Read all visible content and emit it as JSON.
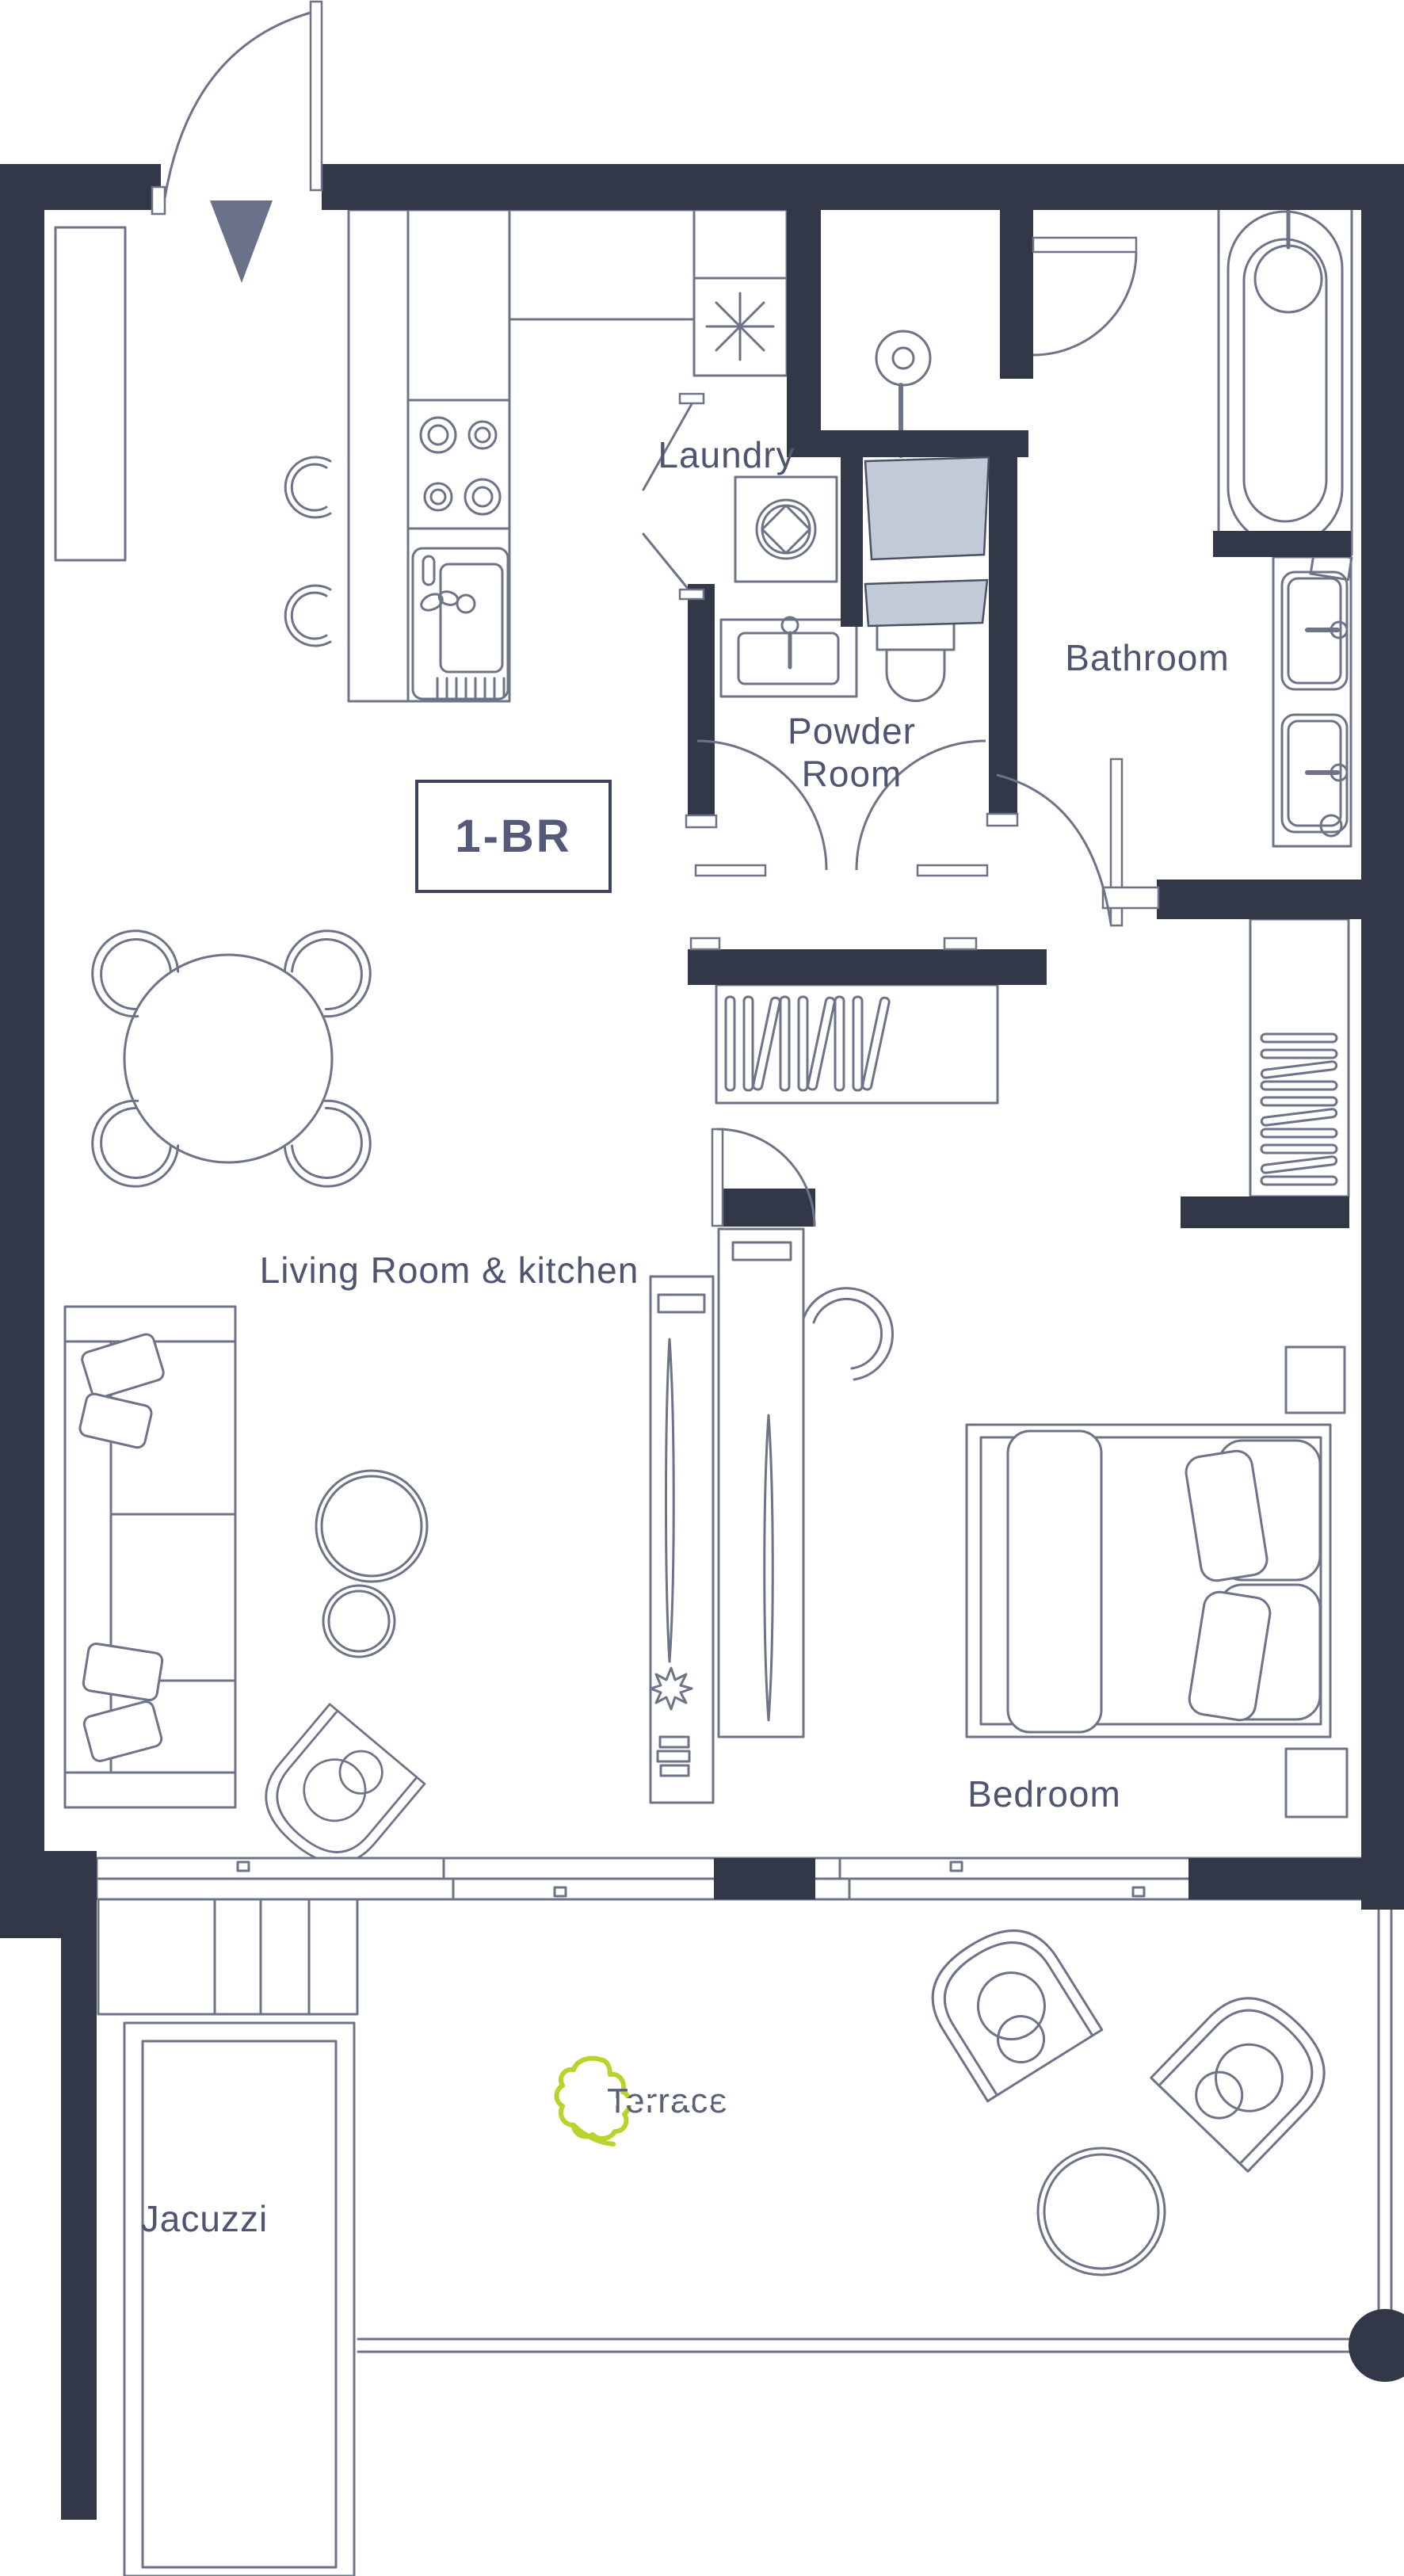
{
  "title": "1-BR apartment floor plan",
  "unit": {
    "label": "1-BR"
  },
  "rooms": {
    "laundry": "Laundry",
    "powder_room": "Powder Room",
    "bathroom": "Bathroom",
    "living_kitchen": "Living Room & kitchen",
    "bedroom": "Bedroom",
    "terrace": "Terrace",
    "jacuzzi": "Jacuzzi"
  },
  "colors": {
    "wall": "#323848",
    "furniture_line": "#6e7487",
    "label_text": "#4f5570",
    "unit_text": "#545a78",
    "glass_partition": "#c3cad7",
    "entry_arrow": "#6a7189",
    "leaf_green": "#b8d32b",
    "background": "#ffffff"
  },
  "fixtures": [
    "entry-door",
    "entry-arrow",
    "left-closet",
    "kitchen-island",
    "stove",
    "kitchen-sink",
    "bar-stools",
    "ceiling-light",
    "laundry-washer",
    "shower",
    "glass-partitions",
    "powder-sink",
    "toilet",
    "bathtub",
    "double-vanity",
    "dining-table",
    "dining-chairs",
    "hall-closet",
    "bedroom-wardrobe",
    "sofa",
    "coffee-tables",
    "armchair",
    "tv-console-living",
    "tv-console-bedroom",
    "swivel-chair",
    "bed",
    "nightstands",
    "sliding-windows",
    "terrace-steps",
    "lounge-chairs",
    "terrace-table",
    "railing",
    "jacuzzi-pool",
    "leaf-logo"
  ]
}
